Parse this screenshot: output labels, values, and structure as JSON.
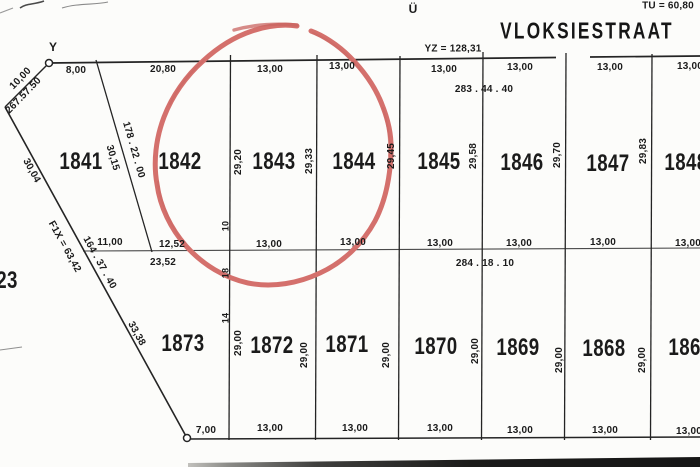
{
  "map": {
    "street": {
      "name": "VLOKSIESTRAAT"
    },
    "marks": {
      "y": "Y",
      "u": "Ü",
      "tu": "TU = 60,80",
      "yz": "YZ = 128,31"
    },
    "annotation": {
      "type": "hand-drawn-circle",
      "color": "#d4706c",
      "highlights_plots": [
        "1842",
        "1843",
        "1844"
      ]
    },
    "line_color": "#222222",
    "plot_numbers": [
      {
        "id": "plot-1841",
        "t": "1841",
        "x": 81,
        "y": 162
      },
      {
        "id": "plot-1842",
        "t": "1842",
        "x": 180,
        "y": 162
      },
      {
        "id": "plot-1843",
        "t": "1843",
        "x": 274,
        "y": 162
      },
      {
        "id": "plot-1844",
        "t": "1844",
        "x": 354,
        "y": 162
      },
      {
        "id": "plot-1845",
        "t": "1845",
        "x": 439,
        "y": 162
      },
      {
        "id": "plot-1846",
        "t": "1846",
        "x": 522,
        "y": 163
      },
      {
        "id": "plot-1847",
        "t": "1847",
        "x": 608,
        "y": 164
      },
      {
        "id": "plot-1848",
        "t": "1848",
        "x": 686,
        "y": 163
      },
      {
        "id": "plot-1873",
        "t": "1873",
        "x": 183,
        "y": 344
      },
      {
        "id": "plot-1872",
        "t": "1872",
        "x": 272,
        "y": 346
      },
      {
        "id": "plot-1871",
        "t": "1871",
        "x": 347,
        "y": 345
      },
      {
        "id": "plot-1870",
        "t": "1870",
        "x": 436,
        "y": 347
      },
      {
        "id": "plot-1869",
        "t": "1869",
        "x": 518,
        "y": 348
      },
      {
        "id": "plot-1868",
        "t": "1868",
        "x": 604,
        "y": 349
      },
      {
        "id": "plot-1867",
        "t": "1867",
        "x": 690,
        "y": 348
      },
      {
        "id": "plot-partial-23",
        "t": "23",
        "x": 7,
        "y": 281
      }
    ],
    "dimension_labels": [
      {
        "t": "8,00",
        "x": 76,
        "y": 71
      },
      {
        "t": "20,80",
        "x": 163,
        "y": 70
      },
      {
        "t": "13,00",
        "x": 270,
        "y": 70
      },
      {
        "t": "13,00",
        "x": 342,
        "y": 67
      },
      {
        "t": "13,00",
        "x": 444,
        "y": 70
      },
      {
        "t": "13,00",
        "x": 520,
        "y": 68
      },
      {
        "t": "13,00",
        "x": 610,
        "y": 68
      },
      {
        "t": "13,00",
        "x": 690,
        "y": 67
      },
      {
        "t": "283 . 44 . 40",
        "x": 484,
        "y": 90
      },
      {
        "t": "10,00",
        "x": 21,
        "y": 79,
        "r": -46
      },
      {
        "t": "267.57.50",
        "x": 24,
        "y": 96,
        "r": -46
      },
      {
        "t": "30,15",
        "x": 112,
        "y": 158,
        "r": 74
      },
      {
        "t": "178 . 22 . 00",
        "x": 133,
        "y": 150,
        "r": 74
      },
      {
        "t": "30,04",
        "x": 31,
        "y": 171,
        "r": 61
      },
      {
        "t": "F1X = 63,42",
        "x": 64,
        "y": 247,
        "r": 61
      },
      {
        "t": "164 . 37 . 40",
        "x": 99,
        "y": 263,
        "r": 61
      },
      {
        "t": "33,38",
        "x": 136,
        "y": 334,
        "r": 61
      },
      {
        "t": "11,00",
        "x": 110,
        "y": 243
      },
      {
        "t": "12,52",
        "x": 172,
        "y": 245
      },
      {
        "t": "23,52",
        "x": 163,
        "y": 263
      },
      {
        "t": "13,00",
        "x": 269,
        "y": 245
      },
      {
        "t": "13,00",
        "x": 353,
        "y": 243
      },
      {
        "t": "13,00",
        "x": 440,
        "y": 244
      },
      {
        "t": "13,00",
        "x": 519,
        "y": 244
      },
      {
        "t": "13,00",
        "x": 603,
        "y": 243
      },
      {
        "t": "13,00",
        "x": 688,
        "y": 244
      },
      {
        "t": "284 . 18 . 10",
        "x": 485,
        "y": 264
      },
      {
        "t": "29,20",
        "x": 239,
        "y": 162,
        "r": -90
      },
      {
        "t": "29,33",
        "x": 310,
        "y": 161,
        "r": -90
      },
      {
        "t": "29,45",
        "x": 392,
        "y": 156,
        "r": -90
      },
      {
        "t": "29,58",
        "x": 474,
        "y": 156,
        "r": -90
      },
      {
        "t": "29,70",
        "x": 558,
        "y": 155,
        "r": -90
      },
      {
        "t": "29,83",
        "x": 644,
        "y": 151,
        "r": -90
      },
      {
        "t": "10",
        "x": 226,
        "y": 226,
        "r": -90,
        "s": 9
      },
      {
        "t": "18",
        "x": 226,
        "y": 273,
        "r": -90,
        "s": 9
      },
      {
        "t": "14",
        "x": 226,
        "y": 318,
        "r": -90,
        "s": 9
      },
      {
        "t": "29,00",
        "x": 239,
        "y": 343,
        "r": -90
      },
      {
        "t": "29,00",
        "x": 305,
        "y": 355,
        "r": -90
      },
      {
        "t": "29,00",
        "x": 387,
        "y": 355,
        "r": -90
      },
      {
        "t": "29,00",
        "x": 476,
        "y": 351,
        "r": -90
      },
      {
        "t": "29,00",
        "x": 560,
        "y": 360,
        "r": -90
      },
      {
        "t": "29,00",
        "x": 643,
        "y": 360,
        "r": -90
      },
      {
        "t": "7,00",
        "x": 206,
        "y": 431
      },
      {
        "t": "13,00",
        "x": 270,
        "y": 429
      },
      {
        "t": "13,00",
        "x": 355,
        "y": 429
      },
      {
        "t": "13,00",
        "x": 440,
        "y": 429
      },
      {
        "t": "13,00",
        "x": 520,
        "y": 431
      },
      {
        "t": "13,00",
        "x": 605,
        "y": 431
      },
      {
        "t": "13,00",
        "x": 689,
        "y": 432
      }
    ]
  }
}
